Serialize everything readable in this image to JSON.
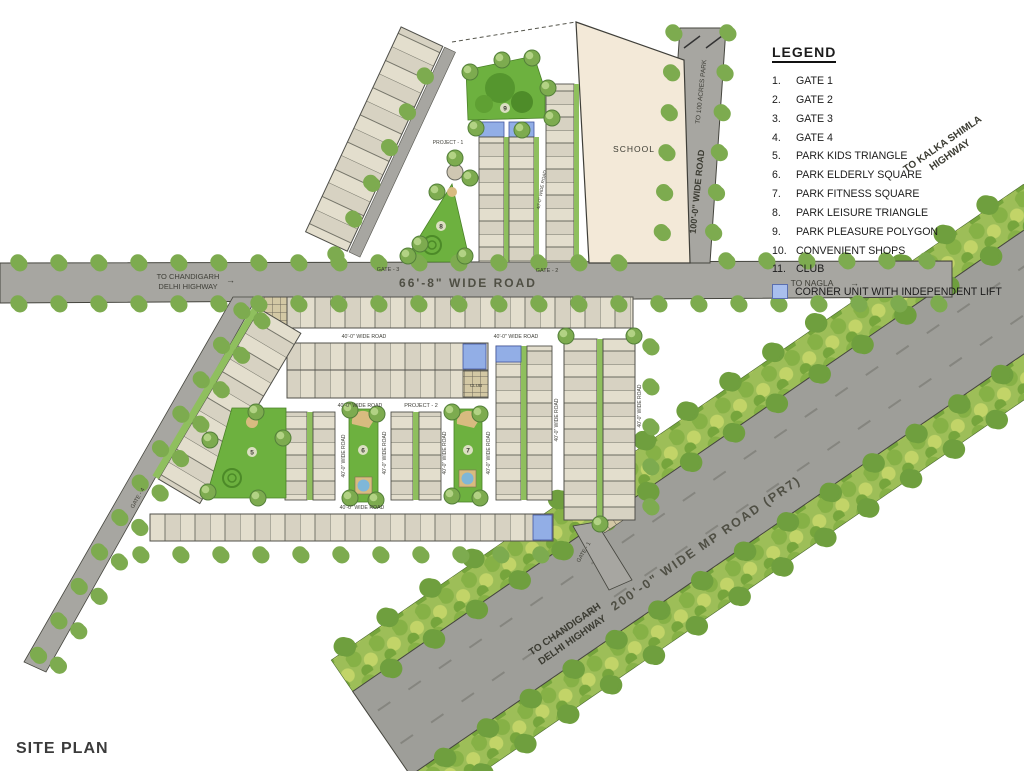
{
  "title": "SITE PLAN",
  "legend": {
    "heading": "LEGEND",
    "items": [
      {
        "num": "1.",
        "label": "GATE 1"
      },
      {
        "num": "2.",
        "label": "GATE 2"
      },
      {
        "num": "3.",
        "label": "GATE 3"
      },
      {
        "num": "4.",
        "label": "GATE 4"
      },
      {
        "num": "5.",
        "label": "PARK KIDS TRIANGLE"
      },
      {
        "num": "6.",
        "label": "PARK ELDERLY SQUARE"
      },
      {
        "num": "7.",
        "label": "PARK FITNESS SQUARE"
      },
      {
        "num": "8.",
        "label": "PARK LEISURE TRIANGLE"
      },
      {
        "num": "9.",
        "label": "PARK PLEASURE POLYGON"
      },
      {
        "num": "10.",
        "label": "CONVENIENT SHOPS"
      },
      {
        "num": "11.",
        "label": "CLUB"
      }
    ],
    "corner_note": "CORNER UNIT WITH INDEPENDENT LIFT"
  },
  "roads": {
    "main": "66'-8\" WIDE ROAD",
    "internal": "40'-0\" WIDE ROAD",
    "wide100": "100'-0\" WIDE ROAD",
    "to_100_acres": "TO 100 ACRES PARK",
    "to_chandigarh_1": "TO CHANDIGARH",
    "to_chandigarh_2": "DELHI HIGHWAY",
    "to_nagla": "TO NAGLA",
    "mp": "200'-0\"  WIDE  MP  ROAD  (PR7)",
    "to_kalka_1": "TO KALKA SHIMLA",
    "to_kalka_2": "HIGHWAY",
    "arrow": "→"
  },
  "labels": {
    "school": "SCHOOL",
    "project1": "PROJECT - 1",
    "project2": "PROJECT - 2",
    "club": "CLUB",
    "gate1": "GATE - 1",
    "gate2": "GATE - 2",
    "gate3": "GATE - 3",
    "gate4": "GATE - 4"
  },
  "parks": {
    "kids": "5",
    "elderly": "6",
    "fitness": "7",
    "leisure": "8",
    "pleasure": "9"
  }
}
